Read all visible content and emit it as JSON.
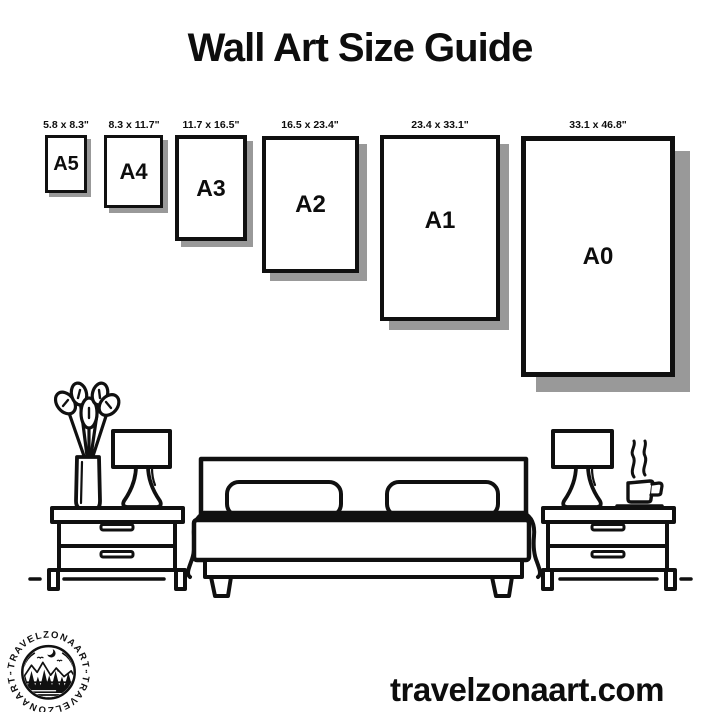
{
  "title": "Wall Art Size Guide",
  "website": "travelzonaart.com",
  "frames": [
    {
      "name": "A5",
      "size_label": "5.8 x 8.3\""
    },
    {
      "name": "A4",
      "size_label": "8.3 x 11.7\""
    },
    {
      "name": "A3",
      "size_label": "11.7 x 16.5\""
    },
    {
      "name": "A2",
      "size_label": "16.5 x 23.4\""
    },
    {
      "name": "A1",
      "size_label": "23.4 x 33.1\""
    },
    {
      "name": "A0",
      "size_label": "33.1 x 46.8\""
    }
  ],
  "logo": {
    "arc_text_top": "·TRAVELZONAART·",
    "arc_text_bottom": "·TRAVELZONAART·"
  },
  "icons": {
    "logo": "mountain-forest-moon-badge",
    "scene": [
      "plant-icon",
      "table-lamp-icon",
      "nightstand-icon",
      "double-bed-icon",
      "coffee-cup-icon",
      "steam-icon"
    ]
  },
  "colors": {
    "background": "#ffffff",
    "ink": "#101010",
    "shadow": "#999999",
    "frame_fill": "#ffffff"
  }
}
